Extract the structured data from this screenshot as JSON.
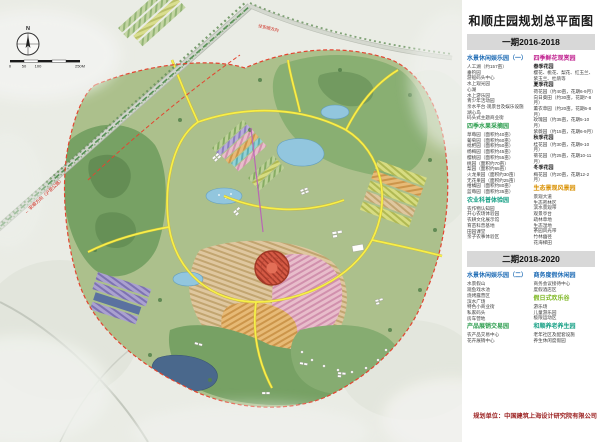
{
  "map": {
    "compass": "N",
    "scale": {
      "labels": [
        "0",
        "50",
        "100",
        "250M"
      ]
    },
    "road_labels": {
      "left": "← 安顺方向（沪昆公路）",
      "top": "往安顺方向"
    }
  },
  "panel": {
    "title": "和顺庄园规划总平面图",
    "credit": "规划单位：中国建筑上海设计研究院有限公司",
    "phase1": {
      "label": "一期2016-2018",
      "columns": [
        {
          "sections": [
            {
              "title": "水景休闲娱乐园（一）",
              "color": "#1f6cb5",
              "items": [
                "人工湖（约157亩）",
                "垂钓园",
                "游船码头中心",
                "水上观光园",
                "心湖",
                "水上游乐园",
                "青少年活动园",
                "亲水平台·观景台及娱乐设施",
                "湖心岛",
                "码头式主题商业街"
              ]
            },
            {
              "title": "四季水果采摘园",
              "color": "#2e9e4f",
              "items": [
                "草莓园（面积约40亩）",
                "葡萄园（面积约60亩）",
                "枇杷园（面积约50亩）",
                "杨梅园（面积约45亩）",
                "樱桃园（面积约55亩）",
                "桃园（面积约70亩）",
                "梨园（面积约65亩）",
                "火龙果园（面积约30亩）",
                "无花果园（面积约25亩）",
                "柑橘园（面积约80亩）",
                "蓝莓园（面积约35亩）"
              ]
            },
            {
              "title": "农业科普体验园",
              "color": "#16a085",
              "items": [
                "农作物认知园",
                "开心农场体验园",
                "农耕文化展示馆",
                "育苗科普基地",
                "田园课堂",
                "亲子农事体验区"
              ]
            }
          ]
        },
        {
          "sections": [
            {
              "title": "四季鲜花观赏园",
              "color": "#c0218f",
              "items": [
                {
                  "t": "春季花园",
                  "b": true
                },
                "樱花、桃花、梨花、红玉兰、紫玉兰、杜鹃等",
                {
                  "t": "夏季花园",
                  "b": true
                },
                "荷花园（约40亩，花期6-9月）",
                "向日葵田（约30亩，花期7-8月）",
                "薰衣草园（约20亩，花期6-8月）",
                "玫瑰园（约35亩，花期5-10月）",
                "紫薇园（约15亩，花期6-9月）",
                {
                  "t": "秋季花园",
                  "b": true
                },
                "桂花园（约30亩，花期9-10月）",
                "菊花园（约25亩，花期10-11月）",
                {
                  "t": "冬季花园",
                  "b": true
                },
                "梅花园（约20亩，花期12-2月）"
              ]
            },
            {
              "title": "生态景观风景园",
              "color": "#d99000",
              "items": [
                "景观大道",
                "生态密林区",
                "滨水景观带",
                "观景亭台",
                "疏林草地",
                "生态湿地",
                "茶园风光带",
                "竹林幽径",
                "花海梯田"
              ]
            }
          ]
        }
      ]
    },
    "phase2": {
      "label": "二期2018-2020",
      "columns": [
        {
          "sections": [
            {
              "title": "水景休闲娱乐园（二）",
              "color": "#1f6cb5",
              "items": [
                "水景假山",
                "观鱼戏水池",
                "烧烤露营区",
                "滨水广场",
                "特色小商业街",
                "私家码头",
                "房车营地"
              ]
            },
            {
              "title": "产品展销交易园",
              "color": "#2e9e4f",
              "items": [
                "农产品交易中心",
                "花卉展销中心"
              ]
            }
          ]
        },
        {
          "sections": [
            {
              "title": "商务度假休闲园",
              "color": "#1f6cb5",
              "items": [
                "商务会议接待中心",
                "度假酒店区"
              ]
            },
            {
              "title": "假日式欢乐谷",
              "color": "#7ab51d",
              "items": [
                "游乐场",
                "儿童游乐园",
                "极限运动区"
              ]
            },
            {
              "title": "和顺养老养生园",
              "color": "#16a085",
              "items": [
                "老年社区及配套设施",
                "养生休闲度假园"
              ]
            }
          ]
        }
      ]
    }
  }
}
